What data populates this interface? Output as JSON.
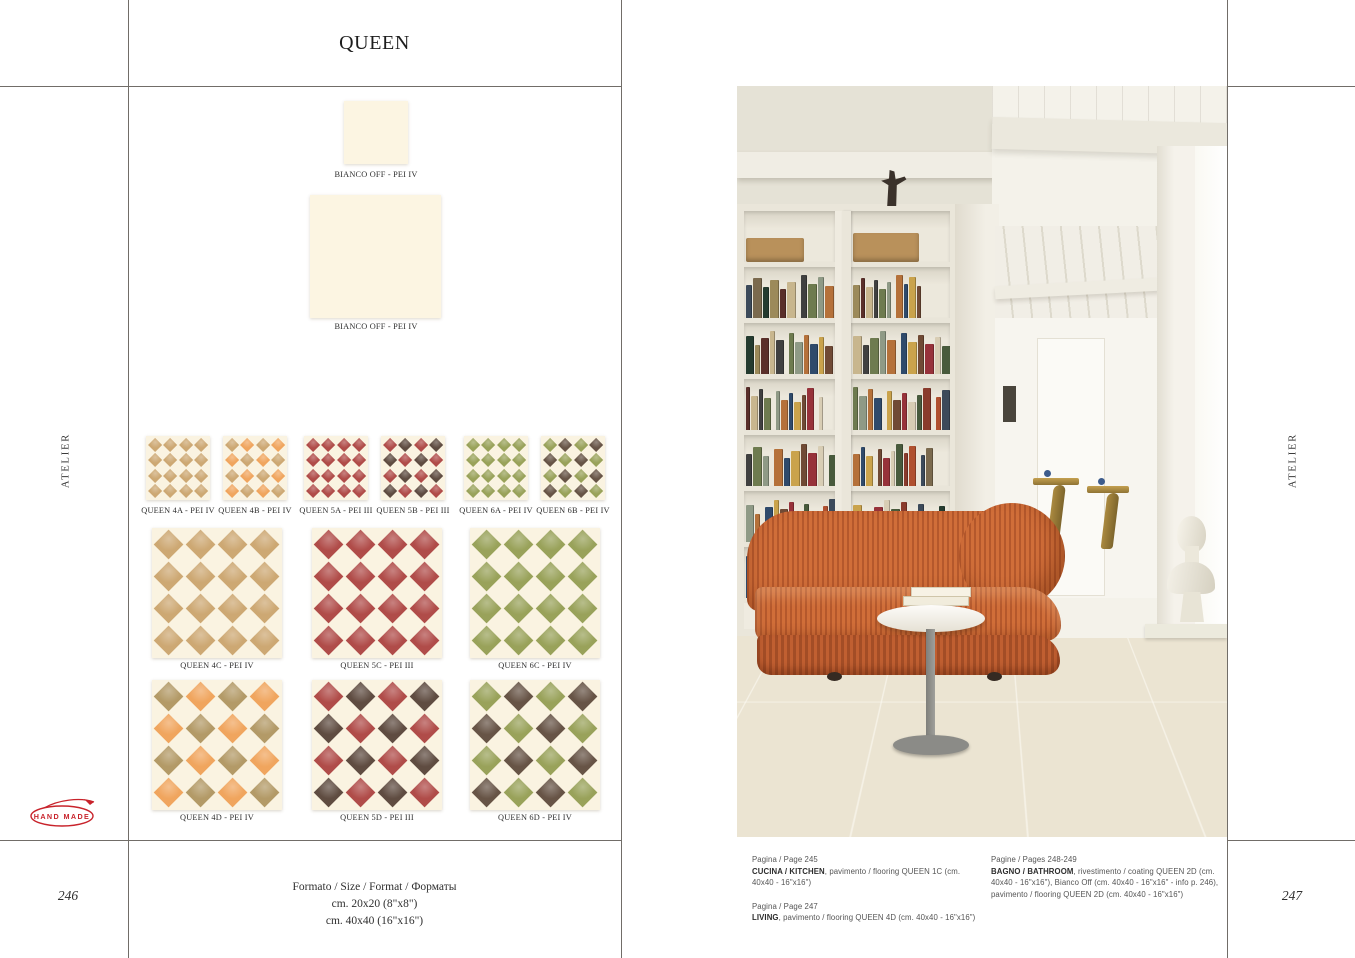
{
  "page": {
    "title": "QUEEN",
    "left_page_number": "246",
    "right_page_number": "247",
    "side_label_left": "ATELIER",
    "side_label_right": "ATELIER",
    "handmade_logo": "HAND MADE"
  },
  "colors": {
    "cream": "#FAF3E1",
    "tan": "#CDA873",
    "orange": "#F0A55E",
    "olive_tan": "#B39A67",
    "red": "#B04C49",
    "dark_brown": "#5F4C41",
    "green": "#99A25A",
    "warm_brown": "#675446",
    "logo_red": "#C8232B",
    "rule_gray": "#716D68"
  },
  "swatches": [
    {
      "label": "BIANCO OFF - PEI IV"
    },
    {
      "label": "BIANCO OFF - PEI IV"
    }
  ],
  "tiles": {
    "row_small": [
      {
        "label": "QUEEN 4A - PEI IV",
        "colors": [
          "tan"
        ]
      },
      {
        "label": "QUEEN 4B - PEI IV",
        "colors": [
          "tan",
          "orange"
        ]
      },
      {
        "label": "QUEEN 5A - PEI III",
        "colors": [
          "red"
        ]
      },
      {
        "label": "QUEEN 5B - PEI III",
        "colors": [
          "red",
          "dark_brown"
        ]
      },
      {
        "label": "QUEEN 6A - PEI IV",
        "colors": [
          "green"
        ]
      },
      {
        "label": "QUEEN 6B - PEI IV",
        "colors": [
          "green",
          "warm_brown"
        ]
      }
    ],
    "row_c": [
      {
        "label": "QUEEN 4C - PEI IV",
        "colors": [
          "tan"
        ]
      },
      {
        "label": "QUEEN 5C - PEI III",
        "colors": [
          "red"
        ]
      },
      {
        "label": "QUEEN 6C - PEI IV",
        "colors": [
          "green"
        ]
      }
    ],
    "row_d": [
      {
        "label": "QUEEN 4D - PEI IV",
        "colors": [
          "olive_tan",
          "orange"
        ]
      },
      {
        "label": "QUEEN 5D - PEI III",
        "colors": [
          "red",
          "dark_brown"
        ]
      },
      {
        "label": "QUEEN 6D - PEI IV",
        "colors": [
          "green",
          "warm_brown"
        ]
      }
    ]
  },
  "formats": {
    "heading": "Formato / Size / Format / Форматы",
    "line1": "cm. 20x20 (8\"x8\")",
    "line2": "cm. 40x40 (16\"x16\")"
  },
  "captions": {
    "col1": [
      {
        "page": "Pagina / Page 245",
        "bold": "CUCINA / KITCHEN",
        "rest": ", pavimento / flooring QUEEN 1C (cm. 40x40 - 16\"x16\")"
      },
      {
        "page": "Pagina / Page 247",
        "bold": "LIVING",
        "rest": ", pavimento / flooring QUEEN 4D (cm. 40x40 - 16\"x16\")"
      }
    ],
    "col2": [
      {
        "page": "Pagine / Pages 248-249",
        "bold": "BAGNO / BATHROOM",
        "rest": ", rivestimento / coating QUEEN 2D (cm. 40x40 - 16\"x16\"), Bianco Off (cm. 40x40 - 16\"x16\" - info p. 246), pavimento / flooring QUEEN 2D (cm. 40x40 - 16\"x16\")"
      }
    ]
  },
  "photo": {
    "floor": {
      "bg": "#EBE4D2",
      "orange": "#CD8656",
      "taupe": "#95846C"
    },
    "sofa_color": "#C8652F",
    "book_colors": [
      "#8a3b2c",
      "#b0502f",
      "#3c4a5a",
      "#7b6a4e",
      "#243b2f",
      "#9c8a5a",
      "#5a2f2a",
      "#c8b68e",
      "#404040",
      "#6e7b4f",
      "#8f9a86",
      "#b5713a",
      "#2f4a6b",
      "#caa34c",
      "#704a35",
      "#97323a",
      "#d8cdb4",
      "#485a3c"
    ],
    "box_color": "#B9915B"
  }
}
